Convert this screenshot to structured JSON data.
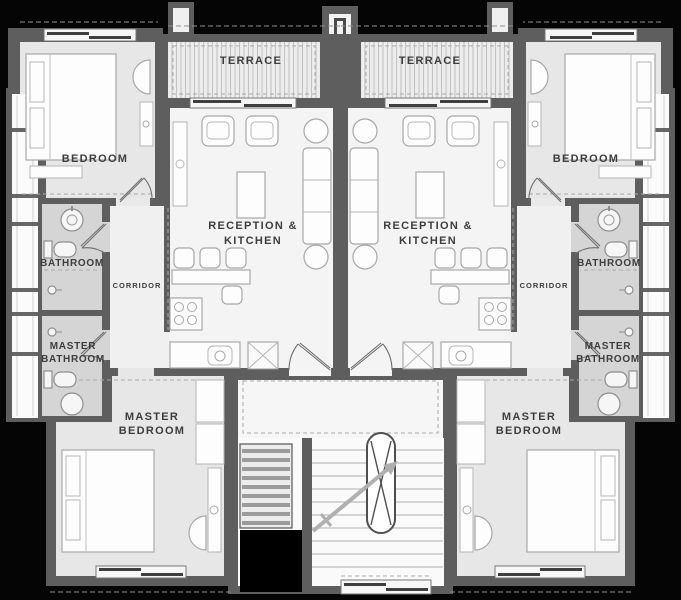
{
  "document_type": "architectural-floor-plan",
  "floor": {
    "units": {
      "left": {
        "terrace": "TERRACE",
        "bedroom": "BEDROOM",
        "reception_line1": "RECEPTION &",
        "reception_line2": "KITCHEN",
        "corridor": "CORRIDOR",
        "bathroom": "BATHROOM",
        "master_bathroom_line1": "MASTER",
        "master_bathroom_line2": "BATHROOM",
        "master_bedroom_line1": "MASTER",
        "master_bedroom_line2": "BEDROOM"
      },
      "right": {
        "terrace": "TERRACE",
        "bedroom": "BEDROOM",
        "reception_line1": "RECEPTION &",
        "reception_line2": "KITCHEN",
        "corridor": "CORRIDOR",
        "bathroom": "BATHROOM",
        "master_bathroom_line1": "MASTER",
        "master_bathroom_line2": "BATHROOM",
        "master_bedroom_line1": "MASTER",
        "master_bedroom_line2": "BEDROOM"
      }
    }
  },
  "colors": {
    "background": "#050505",
    "wall": "#5e5e5e",
    "room_floor": "#e7e7e7",
    "bathroom_floor": "#d5d5d5",
    "reception_floor": "#f4f4f4",
    "corridor_floor": "#f0f0f0",
    "terrace_stripe": "#c4c4c4",
    "label_text": "#3d3d3d"
  },
  "icons": {
    "bed": "rect-with-pillows",
    "armchair": "rounded-rect",
    "sofa": "cushioned-rect",
    "coffee-table": "rect",
    "dining-set": "table-with-chairs",
    "stove": "rect-4-burners",
    "kitchen-sink": "rect-with-circle",
    "washer": "rect-x-cross",
    "toilet": "tank-and-bowl",
    "wash-basin": "circle",
    "shower-head": "small-circle",
    "wall-lamp": "half-disc",
    "closet": "shelved-rect",
    "stairs": "tread-lines",
    "stair-void": "capsule-x",
    "direction-arrow": "diagonal-arrow",
    "sliding-window": "offset-bars",
    "door-swing": "quarter-arc"
  }
}
